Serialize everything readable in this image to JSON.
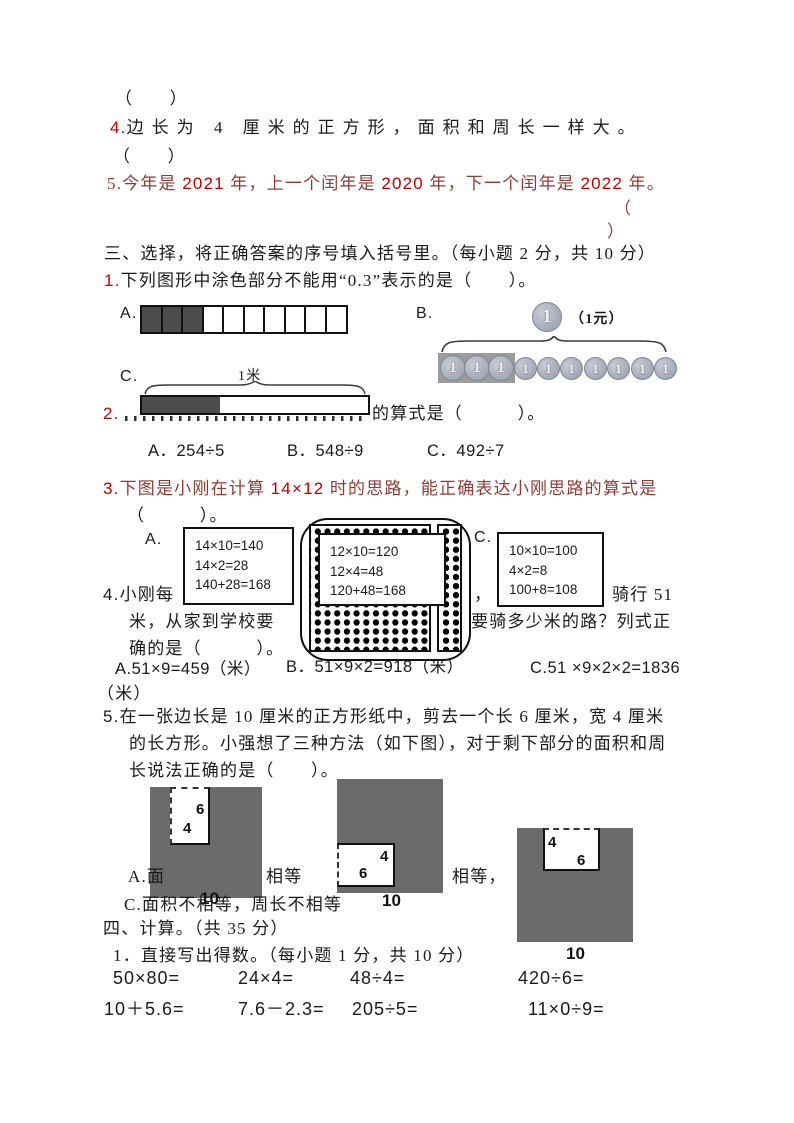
{
  "colors": {
    "dark_red_text": "#8e3b36",
    "bright_red_number": "#c00000",
    "question_number_red": "#c00000",
    "figure_gray": "#6b6b6b",
    "filled_cell_gray": "#4d4d4d",
    "coin_gray": "#aab1bc"
  },
  "judge": {
    "blank1": "（　　）",
    "q4": {
      "num": "4.",
      "text": "边长为 4 厘米的正方形，面积和周长一样大。"
    },
    "blank2": "（　　）",
    "q5": {
      "p0": "5.今年是 ",
      "p1": "2021",
      "p2": " 年，上一个闰年是 ",
      "p3": "2020",
      "p4": " 年，下一个闰年是 ",
      "p5": "2022",
      "p6": " 年。"
    },
    "paren_open": "（",
    "paren_close": "）"
  },
  "sec3": {
    "heading": "三、选择，将正确答案的序号填入括号里。（每小题 2 分，共 10 分）",
    "q1": {
      "num": "1.",
      "text": "下列图形中涂色部分不能用“0.3”表示的是（　　）。",
      "optA": "A.",
      "optB": "B.",
      "optC": "C.",
      "coin_caption": "（1元）",
      "coin_digit": "1",
      "bar_caption": "1米",
      "grid_cells": 10,
      "grid_filled": 3,
      "coin_count": 10,
      "coin_boxed": 3
    },
    "q2": {
      "num": "2.",
      "visible": "的算式是（　　　）。",
      "optA": "A．254÷5",
      "optB": "B．548÷9",
      "optC": "C．492÷7"
    },
    "q3": {
      "num": "3.",
      "p0": "下图是小刚在计算 ",
      "p1": "14×12",
      "p2": " 时的思路，能正确表达小刚思路的算式是",
      "cont": "（　　　）。",
      "optA": "A.",
      "optC": "C.",
      "boxA": [
        "14×10=140",
        "14×2=28",
        "140+28=168"
      ],
      "boxB": [
        "12×10=120",
        "12×4=48",
        "120+48=168"
      ],
      "boxC": [
        "10×10=100",
        "4×2=8",
        "100+8=108"
      ]
    },
    "q4": {
      "num": "4.",
      "f1a": "小刚每",
      "f1b": "，",
      "f1c": "骑行 51",
      "f2a": "米，从家到学校要",
      "f2b": "要骑多少米的路？列式正",
      "f3": "确的是（　　　）。",
      "optA": "A.51×9=459（米）",
      "optB": "B．51×9×2=918（米）",
      "optC": "C.51 ×9×2×2=1836",
      "optC2": "（米）"
    },
    "q5": {
      "num": "5.",
      "line1": "在一张边长是 10 厘米的正方形纸中，剪去一个长 6 厘米，宽 4 厘米",
      "line2": "的长方形。小强想了三种方法（如下图），对于剩下部分的面积和周",
      "line3": "长说法正确的是（　　）。",
      "fragA1": "A.面",
      "fragA2": "相等",
      "fragA3": "相等，",
      "lineC": "C.面积不相等，周长不相等",
      "fig1": {
        "h": "6",
        "w": "4",
        "side": "10"
      },
      "fig2": {
        "h": "4",
        "w": "6",
        "side": "10"
      },
      "fig3": {
        "h": "4",
        "w": "6",
        "side": "10"
      }
    }
  },
  "sec4": {
    "heading": "四、计算。（共 35 分）",
    "sub": "1．直接写出得数。（每小题 1 分，共 10 分）",
    "row1": [
      "50×80=",
      "24×4=",
      "48÷4=",
      "420÷6="
    ],
    "row2": [
      "10＋5.6=",
      "7.6－2.3=",
      "205÷5=",
      "11×0÷9="
    ]
  }
}
